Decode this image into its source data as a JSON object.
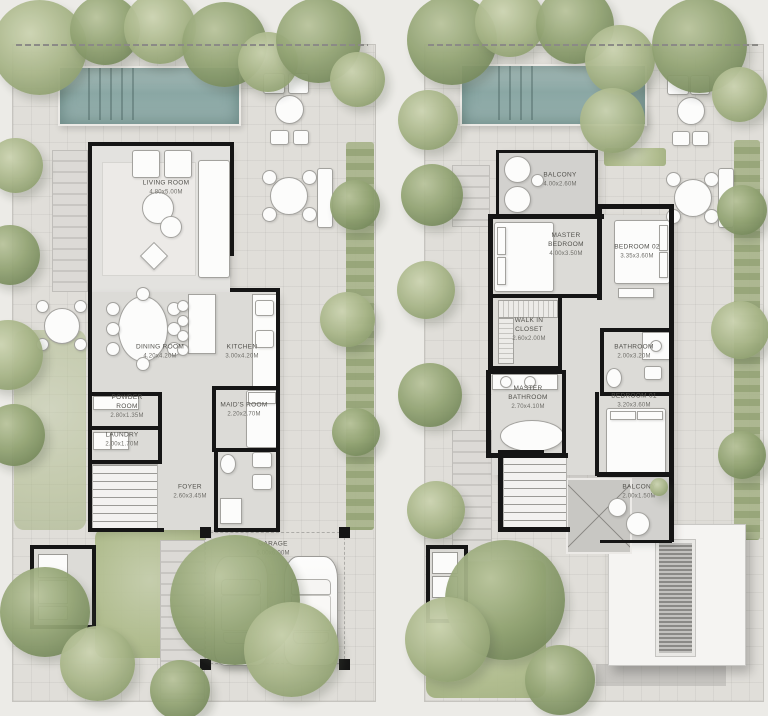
{
  "document": {
    "type": "villa-floor-plans",
    "description": "Two landscaped villa floor plans side by side: ground floor (left) and first floor (right)"
  },
  "colors": {
    "background": "#ecebe7",
    "paving": "#e0ded9",
    "pool": "#8aa7a4",
    "greenery": "#93a474",
    "walls": "#151515",
    "label_text": "#52514c"
  },
  "plans": {
    "ground": {
      "id": "ground-floor-plan",
      "rooms": [
        {
          "name": "LIVING ROOM",
          "dims": "4.80x5.00M"
        },
        {
          "name": "DINING ROOM",
          "dims": "4.20x4.20M"
        },
        {
          "name": "KITCHEN",
          "dims": "3.00x4.20M"
        },
        {
          "name": "POWDER ROOM",
          "dims": "2.80x1.35M"
        },
        {
          "name": "LAUNDRY",
          "dims": "2.00x1.70M"
        },
        {
          "name": "MAID'S ROOM",
          "dims": "2.20x2.70M"
        },
        {
          "name": "FOYER",
          "dims": "2.60x3.45M"
        },
        {
          "name": "GARAGE",
          "dims": "6.00x6.00M"
        }
      ]
    },
    "first": {
      "id": "first-floor-plan",
      "rooms": [
        {
          "name": "BALCONY",
          "dims": "4.00x2.60M"
        },
        {
          "name": "MASTER BEDROOM",
          "dims": "4.00x3.50M"
        },
        {
          "name": "BEDROOM 02",
          "dims": "3.35x3.60M"
        },
        {
          "name": "WALK IN CLOSET",
          "dims": "2.60x2.00M"
        },
        {
          "name": "BATHROOM",
          "dims": "2.00x3.20M"
        },
        {
          "name": "MASTER BATHROOM",
          "dims": "2.70x4.10M"
        },
        {
          "name": "BEDROOM 01",
          "dims": "3.20x3.60M"
        },
        {
          "name": "BALCONY",
          "dims": "2.00x1.50M"
        }
      ]
    }
  }
}
